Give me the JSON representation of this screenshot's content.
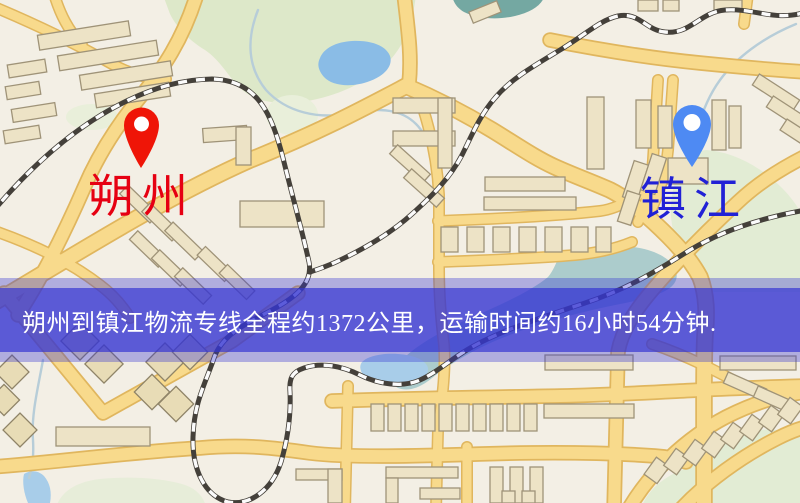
{
  "banner": {
    "text": "朔州到镇江物流专线全程约1372公里，运输时间约16小时54分钟."
  },
  "markers": {
    "origin": {
      "name": "朔州",
      "pin_color": "#ef1507",
      "label_color": "#e60012"
    },
    "destination": {
      "name": "镇江",
      "pin_color": "#4e8af3",
      "label_color": "#2121d6"
    }
  },
  "map": {
    "style_colors": {
      "background": "#f3efe5",
      "road_fill": "#f8da8c",
      "road_casing": "#e0b65e",
      "park_green": "#dde8c9",
      "water_blue": "#8abce6",
      "building": "#ede3c6",
      "railway_dark": "#44403a",
      "banner_overlay": "#3435d2"
    }
  }
}
